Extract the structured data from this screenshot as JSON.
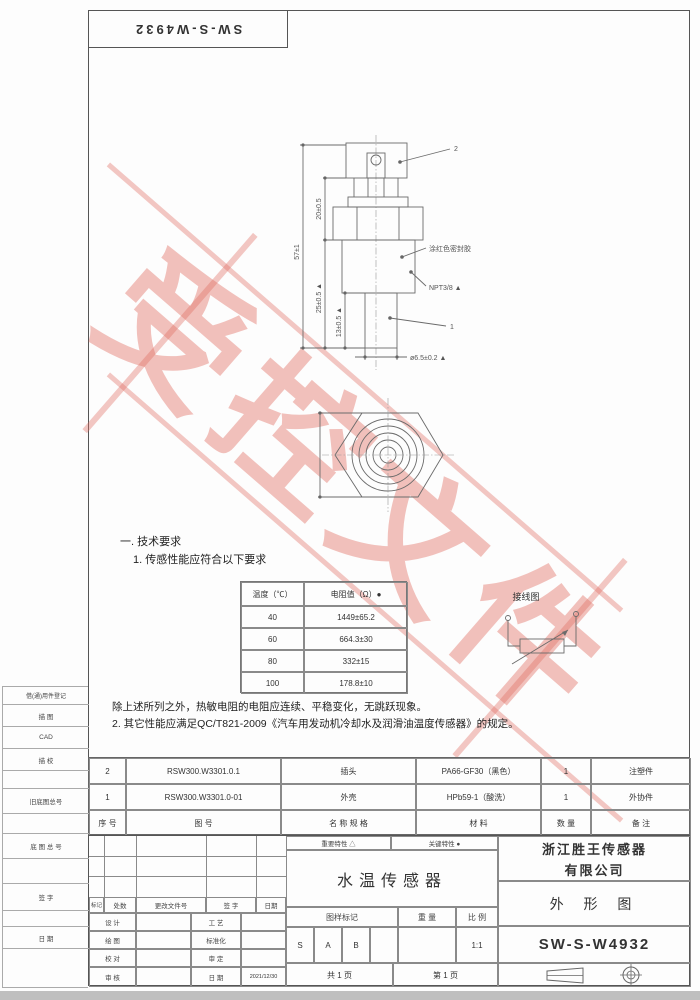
{
  "page": {
    "doc_number_top": "SW-S-W4932",
    "watermark_text": "受控文件"
  },
  "colors": {
    "watermark": "#e06b60",
    "drawing_line": "#6b6b6b"
  },
  "left_margin": {
    "labels": [
      "借(通)用件登记",
      "描  图",
      "CAD",
      "描  校",
      "旧底图总号",
      "底 图 总 号",
      "签  字",
      "日  期"
    ]
  },
  "drawing": {
    "dims": {
      "overall": "57±1",
      "upper": "20±0.5",
      "lower": "25±0.5 ▲",
      "probe": "13±0.5 ▲",
      "probe_dia": "ø6.5±0.2 ▲",
      "thread": "NPT3/8 ▲",
      "seal_note": "涂红色密封胶",
      "balloon_1": "1",
      "balloon_2": "2"
    },
    "wiring_label": "接线图"
  },
  "tech": {
    "heading": "一. 技术要求",
    "line1": "1. 传感性能应符合以下要求",
    "table": {
      "headers": [
        "温度（℃）",
        "电阻值（Ω）●"
      ],
      "rows": [
        [
          "40",
          "1449±65.2"
        ],
        [
          "60",
          "664.3±30"
        ],
        [
          "80",
          "332±15"
        ],
        [
          "100",
          "178.8±10"
        ]
      ]
    },
    "note": "除上述所列之外，热敏电阻的电阻应连续、平稳变化，无跳跃现象。",
    "line2": "2. 其它性能应满足QC/T821-2009《汽车用发动机冷却水及润滑油温度传感器》的规定。"
  },
  "parts": {
    "headers": [
      "序 号",
      "图      号",
      "名 称 规 格",
      "材      料",
      "数 量",
      "备 注"
    ],
    "rows": [
      {
        "no": "2",
        "code": "RSW300.W3301.0.1",
        "name": "插头",
        "material": "PA66-GF30（黑色）",
        "qty": "1",
        "remark": "注塑件"
      },
      {
        "no": "1",
        "code": "RSW300.W3301.0-01",
        "name": "外壳",
        "material": "HPb59-1（酸洗）",
        "qty": "1",
        "remark": "外协件"
      }
    ]
  },
  "title_block": {
    "important_label": "重要特性  △",
    "key_label": "关键特性  ●",
    "product_name": "水温传感器",
    "company_line1": "浙江胜王传感器",
    "company_line2": "有限公司",
    "view_type": "外  形  图",
    "drawing_number": "SW-S-W4932",
    "rev_headers": [
      "标记",
      "处数",
      "更改文件号",
      "签 字",
      "日期"
    ],
    "rev_rows": [
      [
        "设 计",
        "工 艺"
      ],
      [
        "绘 图",
        "标准化"
      ],
      [
        "校 对",
        "审 定"
      ],
      [
        "审 核",
        "日 期"
      ]
    ],
    "date_value": "2021/12/30",
    "stamp_label": "图样标记",
    "stamp_values": [
      "S",
      "A",
      "B"
    ],
    "weight_label": "重 量",
    "scale_label": "比 例",
    "scale_value": "1:1",
    "sheet_count": "共   1   页",
    "sheet_index": "第   1   页"
  }
}
